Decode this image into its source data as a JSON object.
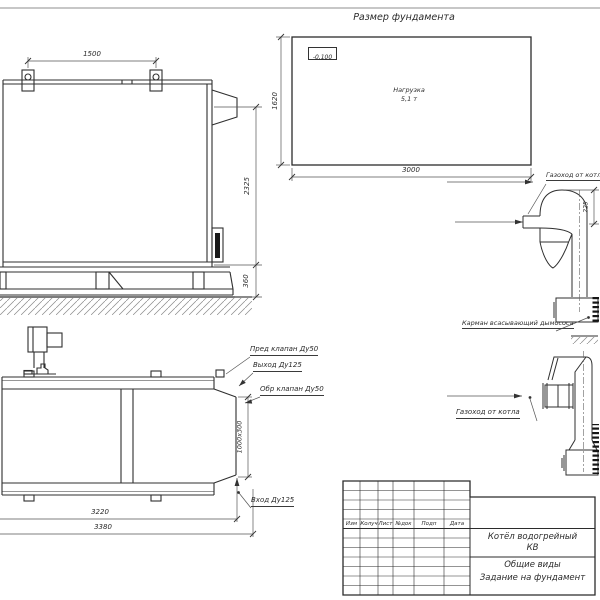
{
  "foundation_plan": {
    "title": "Размер фундамента",
    "elevation_mark": "-0,100",
    "load_line1": "Нагрузка",
    "load_line2": "5,1 т",
    "dim_width": "3000",
    "dim_depth": "1620"
  },
  "side_view": {
    "dim_lug_spacing": "1500",
    "dim_height": "2325",
    "dim_base_height": "360"
  },
  "plan_view": {
    "label_safety_valve": "Пред клапан Ду50",
    "label_outlet": "Выход Ду125",
    "label_check_valve": "Обр клапан Ду50",
    "label_inlet": "Вход Ду125",
    "dim_opening": "1000х300",
    "dim_length_inner": "3220",
    "dim_length_outer": "3380"
  },
  "flue_side_detail": {
    "label_duct": "Газоход от котла",
    "label_pocket": "Карман всасывающий дымососа",
    "dim_offset": "225"
  },
  "flue_front_detail": {
    "label_duct": "Газоход от котла"
  },
  "title_block": {
    "columns": [
      "Изм",
      "Колуч",
      "Лист",
      "№док",
      "Подп",
      "Дата"
    ],
    "product_name": "Котёл водогрейный",
    "product_code": "КВ",
    "doc_line1": "Общие виды",
    "doc_line2": "Задание на фундамент"
  }
}
